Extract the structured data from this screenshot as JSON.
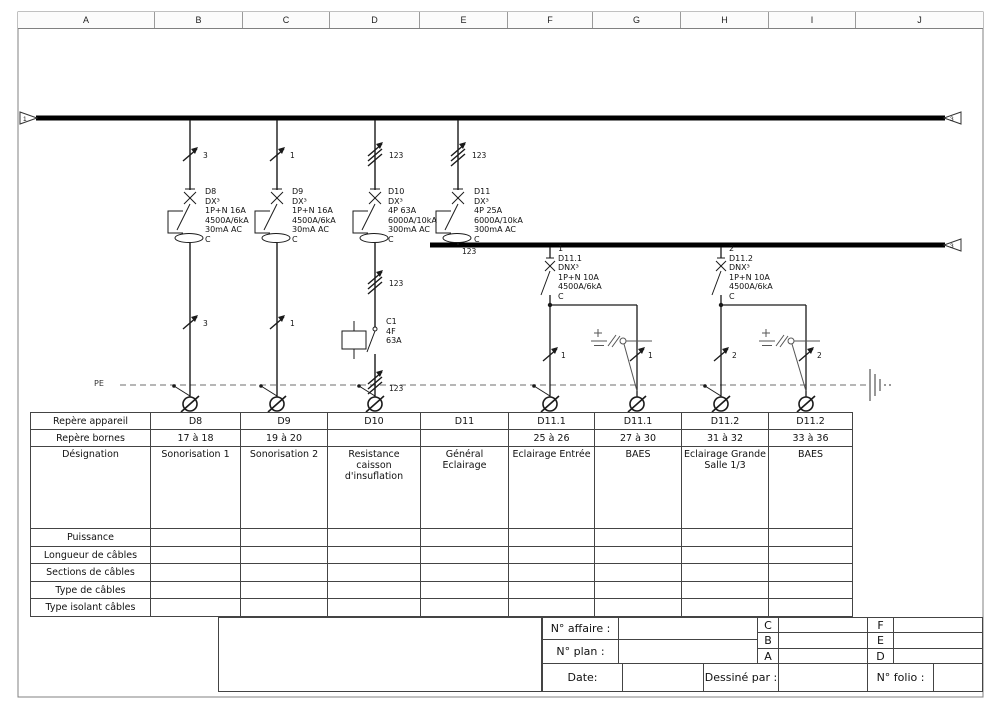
{
  "frame": {
    "columns": [
      "A",
      "B",
      "C",
      "D",
      "E",
      "F",
      "G",
      "H",
      "I",
      "J"
    ],
    "busbar1_left_ref": "1",
    "busbar1_right_ref": "3",
    "busbar2_right_ref": "3",
    "pe_label": "PE"
  },
  "feeders": [
    {
      "top_count": "3",
      "block": "D8\nDX³\n1P+N 16A\n4500A/6kA\n30mA AC\nC",
      "bottom_count": "3"
    },
    {
      "top_count": "1",
      "block": "D9\nDX³\n1P+N 16A\n4500A/6kA\n30mA AC\nC",
      "bottom_count": "1"
    },
    {
      "top_count": "123",
      "block": "D10\nDX³\n4P 63A\n6000A/10kA\n300mA AC\nC",
      "mid_count": "123",
      "contactor": "C1\n4F\n63A",
      "bottom_count": "123"
    },
    {
      "top_count": "123",
      "block": "D11\nDX³\n4P 25A\n6000A/10kA\n300mA AC\nC",
      "busbar_count": "123"
    }
  ],
  "subfeeders": [
    {
      "block": "1\nD11.1\nDNX³\n1P+N 10A\n4500A/6kA\nC",
      "left_count": "1",
      "right_count": "1"
    },
    {
      "block": "2\nD11.2\nDNX³\n1P+N 10A\n4500A/6kA\nC",
      "left_count": "2",
      "right_count": "2"
    }
  ],
  "table": {
    "row_labels": [
      "Repère appareil",
      "Repère bornes",
      "Désignation",
      "Puissance",
      "Longueur de câbles",
      "Sections de câbles",
      "Type de câbles",
      "Type isolant câbles"
    ],
    "appareil": [
      "D8",
      "D9",
      "D10",
      "D11",
      "D11.1",
      "D11.1",
      "D11.2",
      "D11.2"
    ],
    "bornes": [
      "17 à 18",
      "19 à 20",
      "",
      "",
      "25 à 26",
      "27 à 30",
      "31 à 32",
      "33 à 36"
    ],
    "designation": [
      "Sonorisation 1",
      "Sonorisation 2",
      "Resistance caisson d'insuflation",
      "Général Eclairage",
      "Eclairage Entrée",
      "BAES",
      "Eclairage Grande Salle 1/3",
      "BAES"
    ]
  },
  "titleblock": {
    "affaire_label": "N° affaire :",
    "plan_label": "N° plan :",
    "date_label": "Date:",
    "dessine_label": "Dessiné par :",
    "folio_label": "N° folio :",
    "rev_left": [
      "C",
      "B",
      "A"
    ],
    "rev_right": [
      "F",
      "E",
      "D"
    ]
  }
}
